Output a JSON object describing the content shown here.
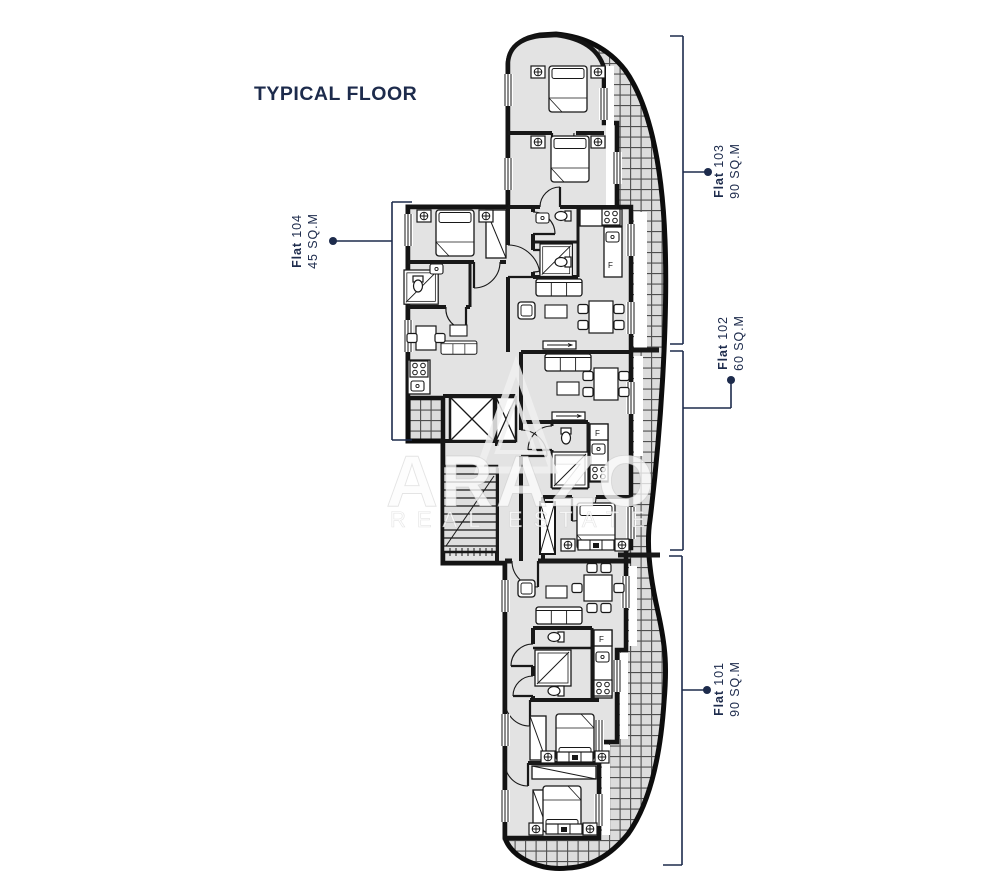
{
  "title": "TYPICAL FLOOR",
  "flats": {
    "f101": {
      "prefix": "Flat",
      "number": "101",
      "area": "90 SQ.M"
    },
    "f102": {
      "prefix": "Flat",
      "number": "102",
      "area": "60 SQ.M"
    },
    "f103": {
      "prefix": "Flat",
      "number": "103",
      "area": "90 SQ.M"
    },
    "f104": {
      "prefix": "Flat",
      "number": "104",
      "area": "45 SQ.M"
    }
  },
  "watermark": {
    "brand": "ARAZO",
    "tagline": "REAL ESTATE"
  },
  "plan": {
    "fridge_label": "F"
  },
  "colors": {
    "navy": "#1d2b4c",
    "plan_line": "#181818",
    "room_fill": "#e3e3e3",
    "hatch_bg": "#dcdcdc",
    "hatch_line": "#4f4f4f"
  }
}
